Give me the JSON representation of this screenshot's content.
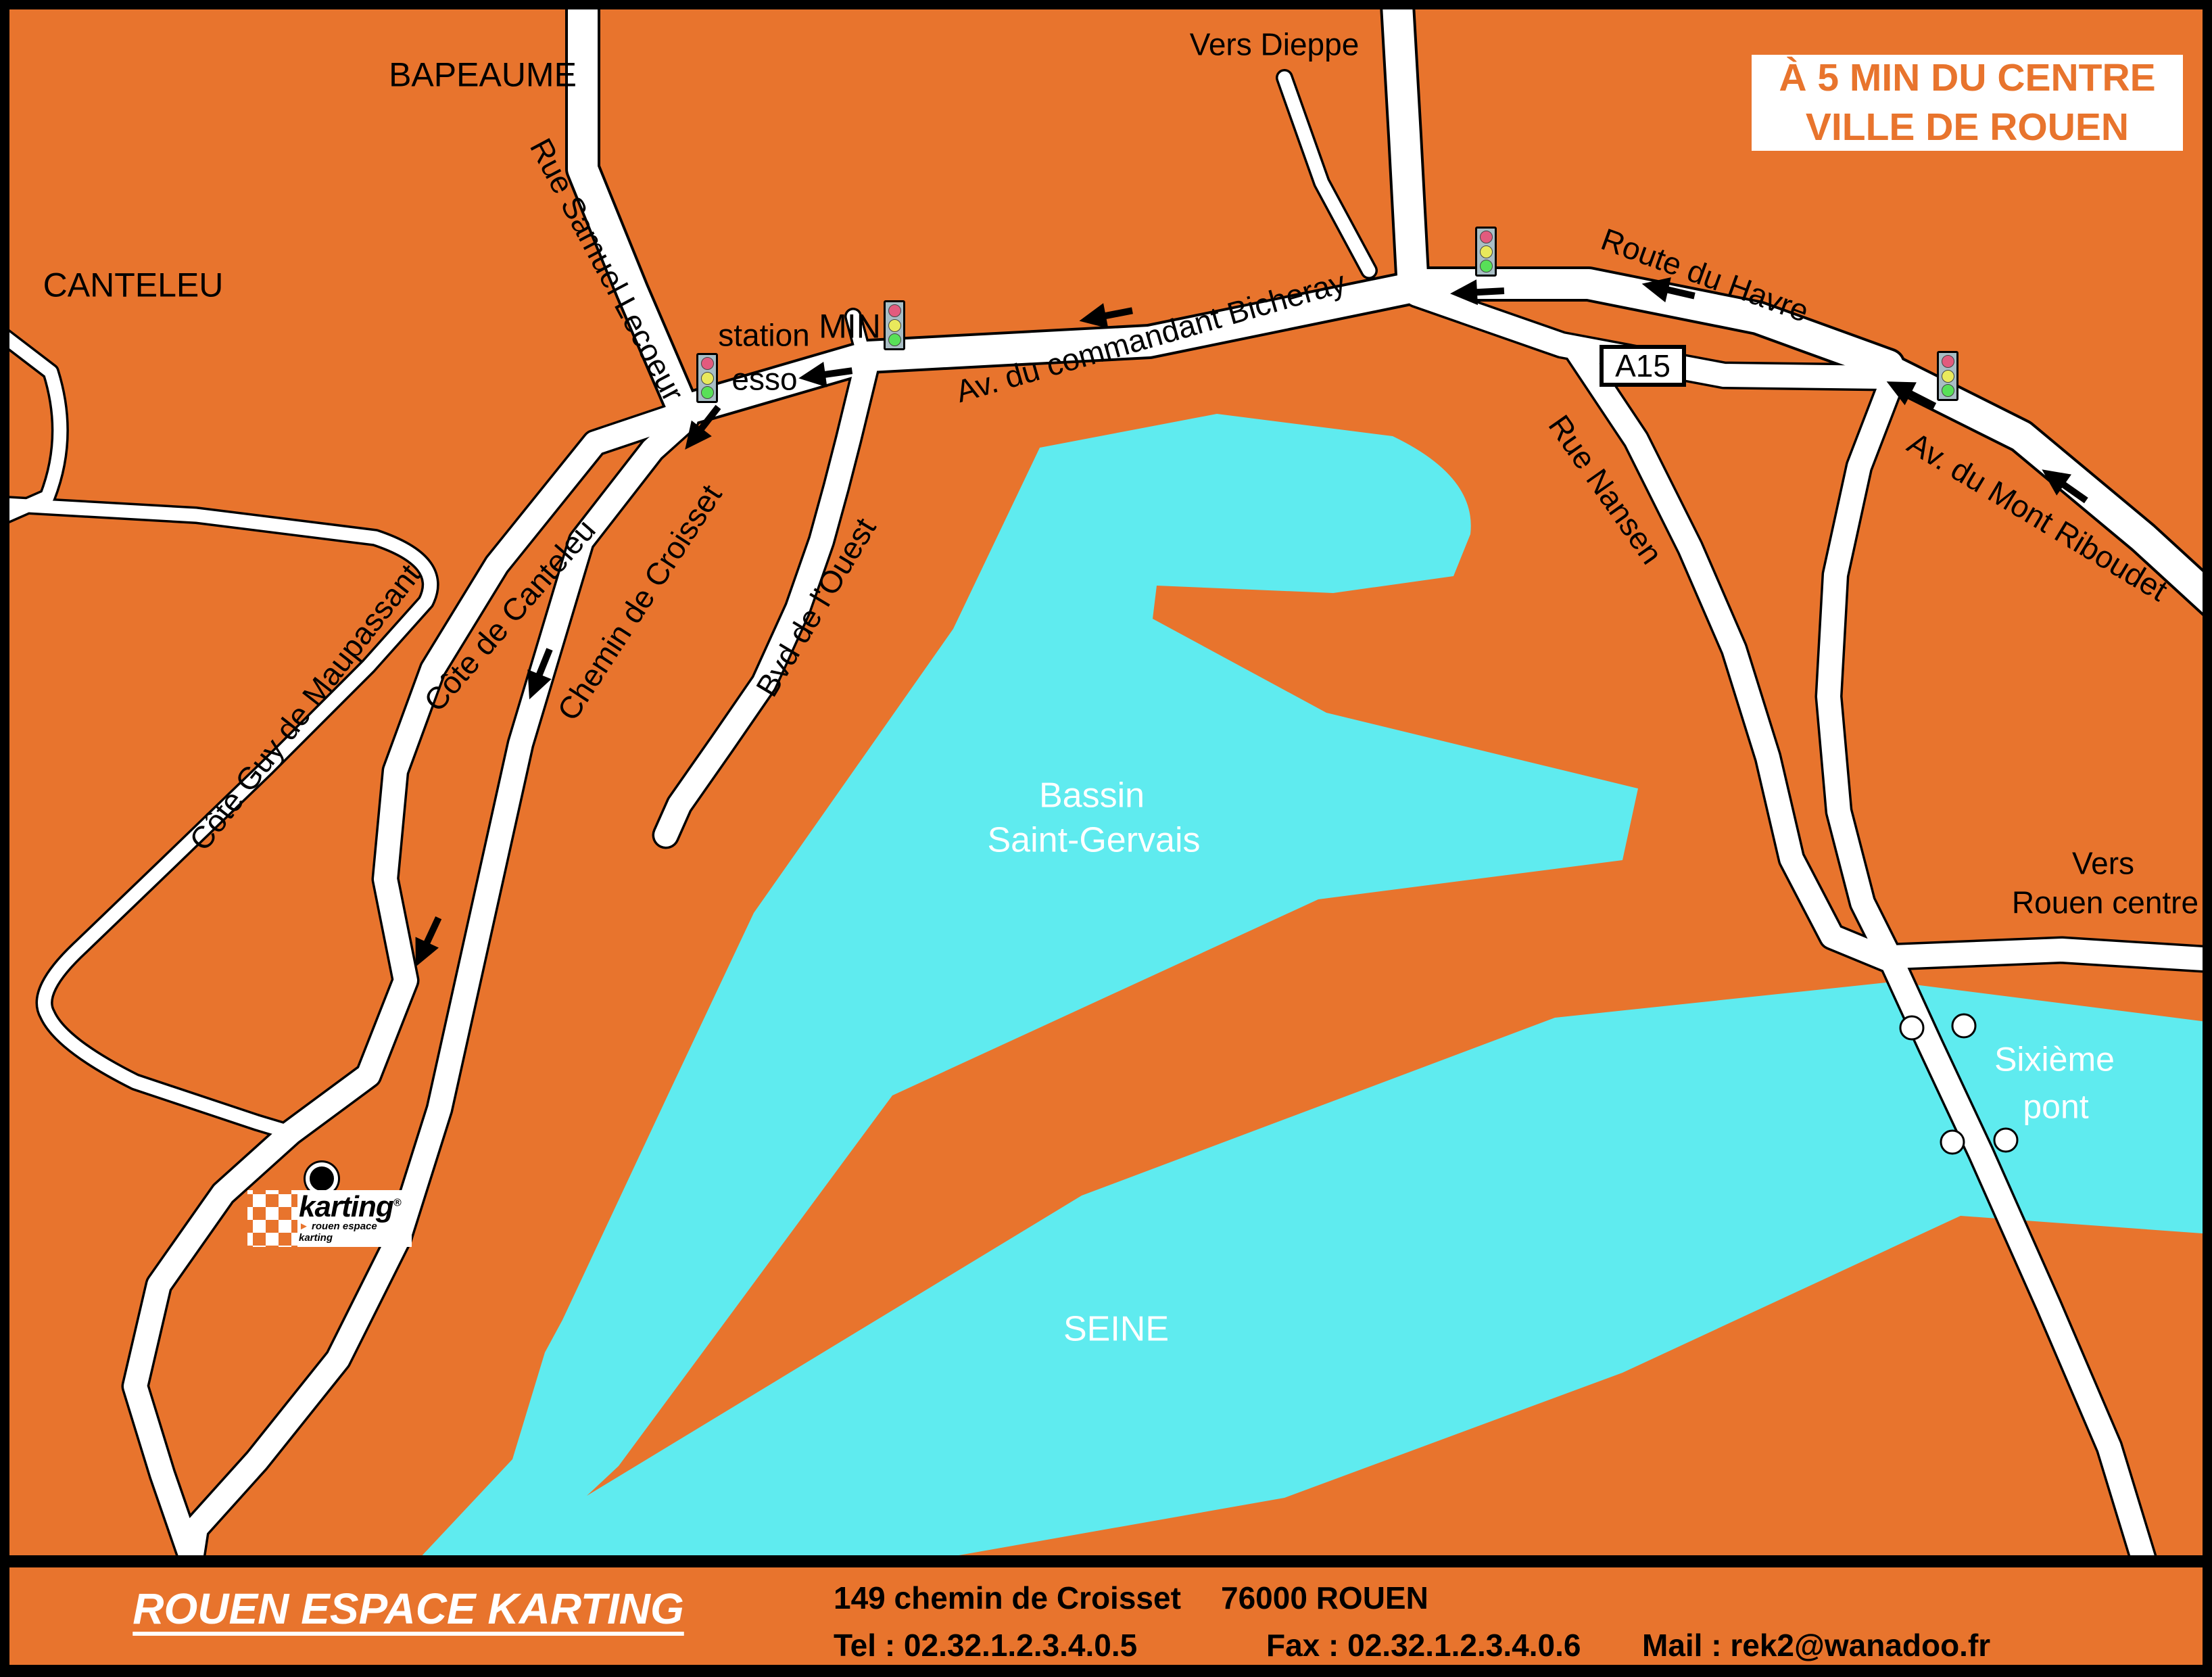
{
  "meta": {
    "description": "Access map to Rouen Espace Karting, 5 minutes from Rouen city centre",
    "colors": {
      "land_orange": "#E8742D",
      "water_cyan": "#5FEBEF",
      "road_white": "#FFFFFF",
      "outline_black": "#000000",
      "traffic_light_body": "#A9BEC5",
      "traffic_light_red": "#E25B7E",
      "traffic_light_yellow": "#E9E95C",
      "traffic_light_green": "#58E058"
    },
    "icons": {
      "traffic_light": "traffic-light-icon",
      "direction_arrow": "direction-arrow-icon",
      "location_marker": "location-marker-icon",
      "bridge_pier": "bridge-pier-icon"
    }
  },
  "title_box": {
    "line1": "À 5 MIN DU CENTRE",
    "line2": "VILLE DE ROUEN"
  },
  "map": {
    "labels": {
      "bapeaume": "BAPEAUME",
      "canteleu": "CANTELEU",
      "vers_dieppe": "Vers Dieppe",
      "station": "station",
      "esso": "esso",
      "min": "MIN",
      "bicheray": "Av. du commandant Bicheray",
      "route_havre": "Route du Havre",
      "a15": "A15",
      "riboudet": "Av. du Mont Riboudet",
      "nansen": "Rue Nansen",
      "lecoeur": "Rue Samuel Lecoeur",
      "cote_canteleu": "Côte de Canteleu",
      "croisset": "Chemin de Croisset",
      "ouest": "Bvd de l'Ouest",
      "maupassant": "Côte Guy de Maupassant",
      "bassin_l1": "Bassin",
      "bassin_l2": "Saint-Gervais",
      "seine": "SEINE",
      "vers_rouen_l1": "Vers",
      "vers_rouen_l2": "Rouen centre",
      "sixieme_l1": "Sixième",
      "sixieme_l2": "pont"
    }
  },
  "logo": {
    "brand": "karting",
    "registered": "®",
    "bullet": "►",
    "tagline": "rouen espace karting"
  },
  "footer": {
    "company": "ROUEN ESPACE KARTING",
    "address_street": "149 chemin de Croisset",
    "address_city": "76000 ROUEN",
    "tel": "Tel : 02.32.1.2.3.4.0.5",
    "fax": "Fax : 02.32.1.2.3.4.0.6",
    "mail": "Mail : rek2@wanadoo.fr"
  }
}
